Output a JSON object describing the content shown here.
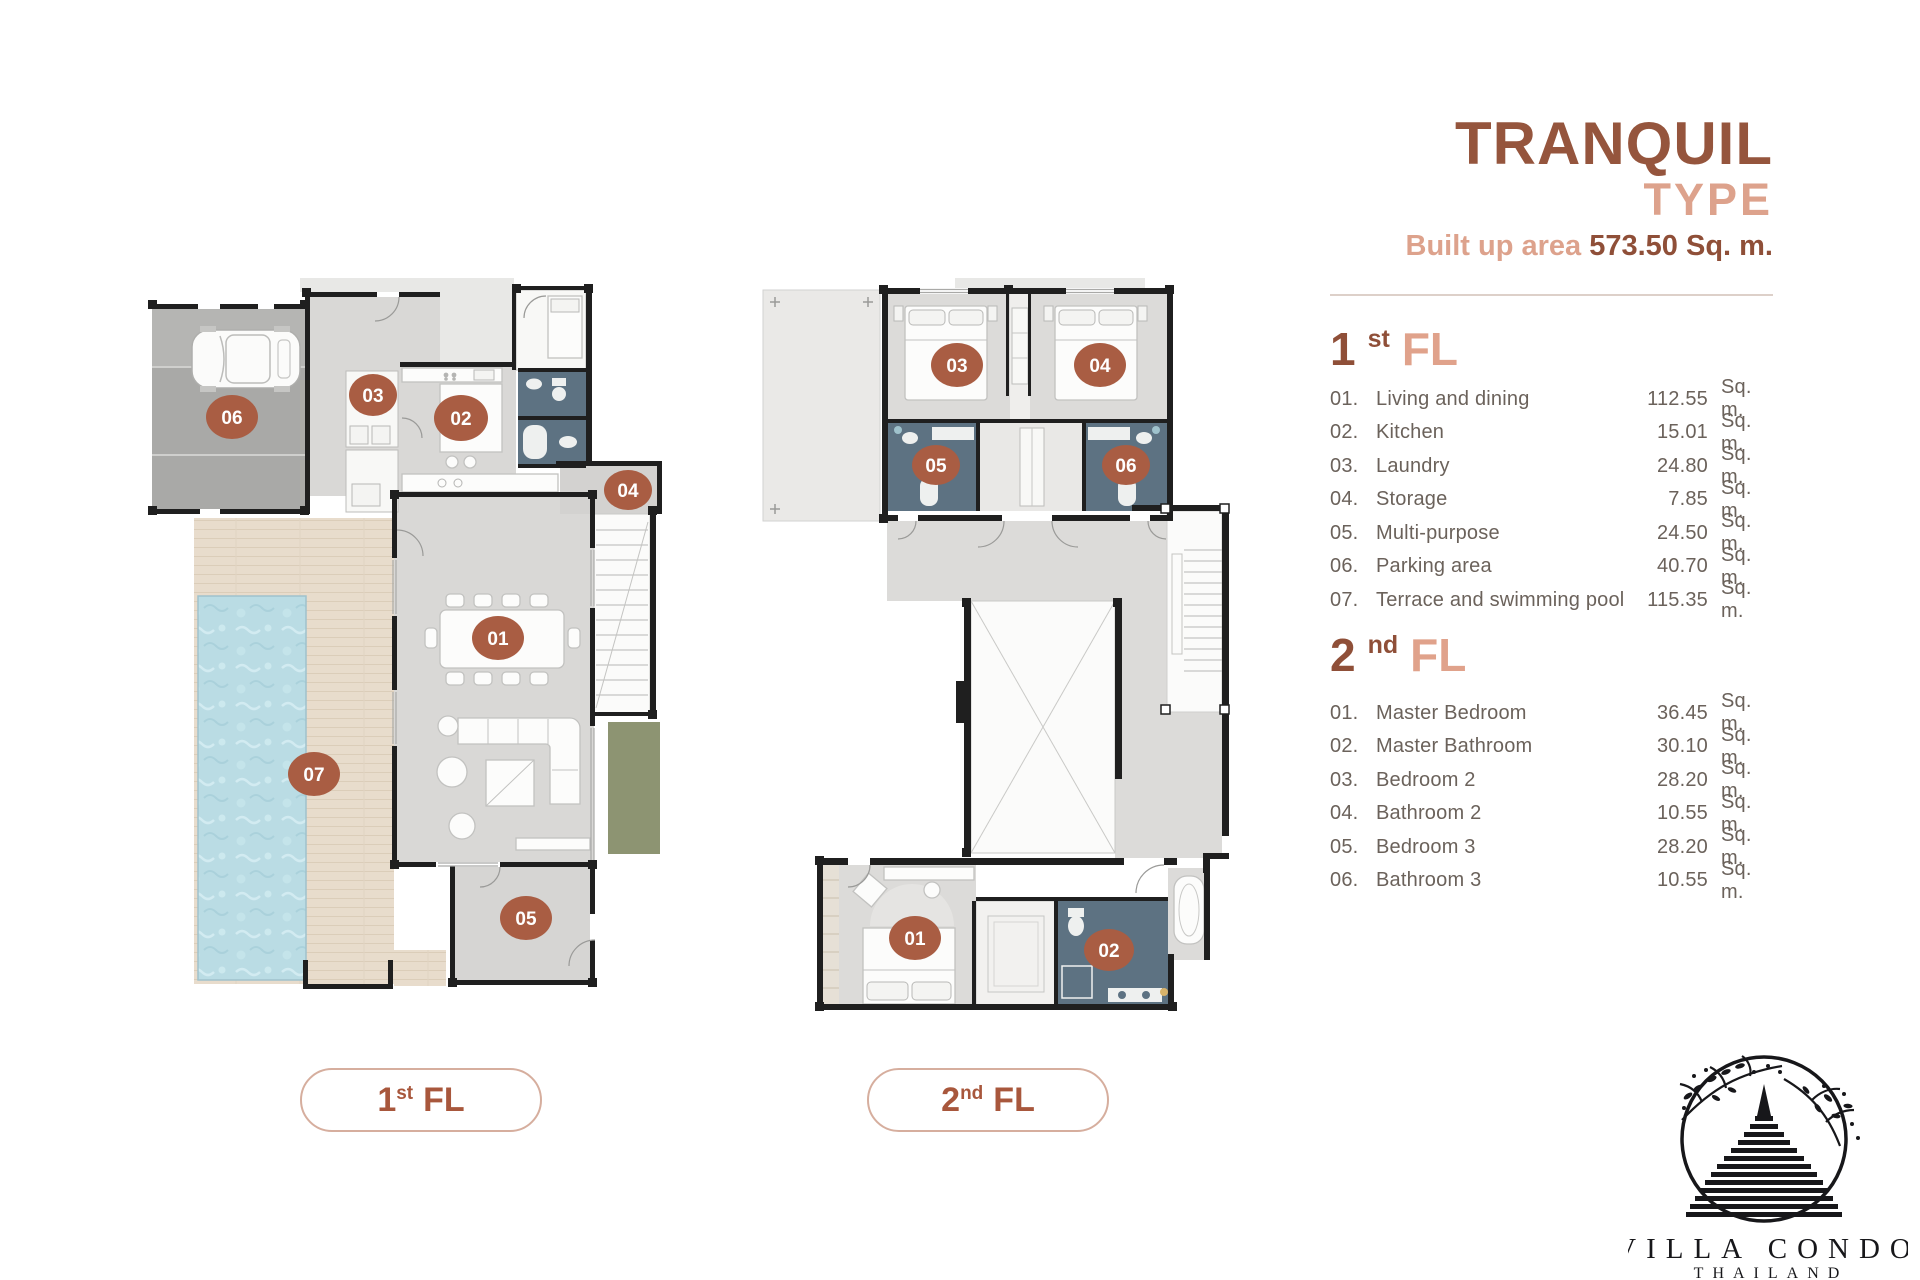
{
  "header": {
    "title": "TRANQUIL",
    "subtitle": "TYPE",
    "built_up_label": "Built up area",
    "built_up_value": "573.50 Sq. m."
  },
  "floor1": {
    "heading": {
      "num": "1",
      "sup": "st",
      "word": "FL"
    },
    "items": [
      {
        "no": "01.",
        "name": "Living and dining",
        "area": "112.55",
        "unit": "Sq. m."
      },
      {
        "no": "02.",
        "name": "Kitchen",
        "area": "15.01",
        "unit": "Sq. m."
      },
      {
        "no": "03.",
        "name": "Laundry",
        "area": "24.80",
        "unit": "Sq. m."
      },
      {
        "no": "04.",
        "name": "Storage",
        "area": "7.85",
        "unit": "Sq. m."
      },
      {
        "no": "05.",
        "name": "Multi-purpose",
        "area": "24.50",
        "unit": "Sq. m."
      },
      {
        "no": "06.",
        "name": "Parking area",
        "area": "40.70",
        "unit": "Sq. m."
      },
      {
        "no": "07.",
        "name": "Terrace and swimming pool",
        "area": "115.35",
        "unit": "Sq. m."
      }
    ]
  },
  "floor2": {
    "heading": {
      "num": "2",
      "sup": "nd",
      "word": "FL"
    },
    "items": [
      {
        "no": "01.",
        "name": "Master Bedroom",
        "area": "36.45",
        "unit": "Sq. m."
      },
      {
        "no": "02.",
        "name": "Master Bathroom",
        "area": "30.10",
        "unit": "Sq. m."
      },
      {
        "no": "03.",
        "name": "Bedroom 2",
        "area": "28.20",
        "unit": "Sq. m."
      },
      {
        "no": "04.",
        "name": "Bathroom 2",
        "area": "10.55",
        "unit": "Sq. m."
      },
      {
        "no": "05.",
        "name": "Bedroom 3",
        "area": "28.20",
        "unit": "Sq. m."
      },
      {
        "no": "06.",
        "name": "Bathroom 3",
        "area": "10.55",
        "unit": "Sq. m."
      }
    ]
  },
  "pills": [
    {
      "num": "1",
      "sup": "st",
      "word": "FL"
    },
    {
      "num": "2",
      "sup": "nd",
      "word": "FL"
    }
  ],
  "plan1": {
    "badges": [
      "06",
      "03",
      "02",
      "04",
      "01",
      "07",
      "05"
    ]
  },
  "plan2": {
    "badges": [
      "03",
      "04",
      "05",
      "06",
      "01",
      "02"
    ]
  },
  "logo": {
    "brand": "VILLA CONDO",
    "country": "THAILAND"
  },
  "colors": {
    "accent_dark": "#95553d",
    "accent_light": "#dda28c",
    "badge": "#a95d43",
    "bathroom_blue": "#5d7282",
    "pool_blue": "#badce4",
    "deck_beige": "#e8dccc",
    "garage_gray": "#a9a9a7",
    "floor_gray": "#d9d8d6",
    "garden_green": "#8d9472"
  }
}
